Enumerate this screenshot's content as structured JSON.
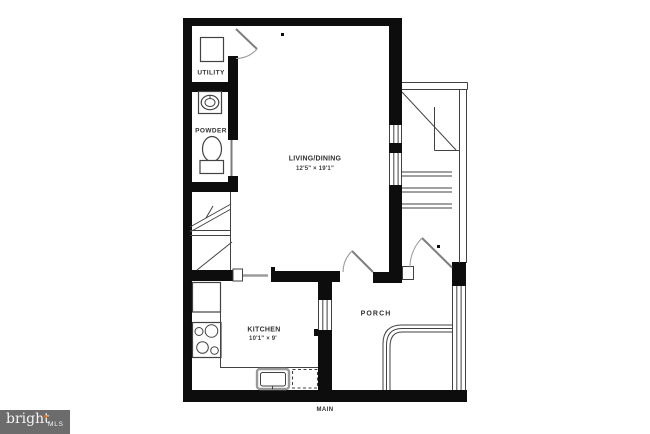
{
  "colors": {
    "wall": "#0d0d0d",
    "line": "#424242",
    "leaf": "#7d7d7d",
    "arc": "#9b9b9b",
    "text": "#303030",
    "dim": "#3d3d3d",
    "logo-bg": "#6d6c6c",
    "logo-text": "#f5f5f4",
    "logo-accent": "#dc7226"
  },
  "rooms": {
    "utility": {
      "label": "UTILITY"
    },
    "powder": {
      "label": "POWDER"
    },
    "living": {
      "label": "LIVING/DINING",
      "dims": "12'5\" × 19'1\""
    },
    "kitchen": {
      "label": "KITCHEN",
      "dims": "10'1\" × 9'"
    },
    "porch": {
      "label": "PORCH"
    }
  },
  "floor": {
    "label": "MAIN"
  },
  "logo": {
    "brand": "bright",
    "suffix": "MLS"
  }
}
